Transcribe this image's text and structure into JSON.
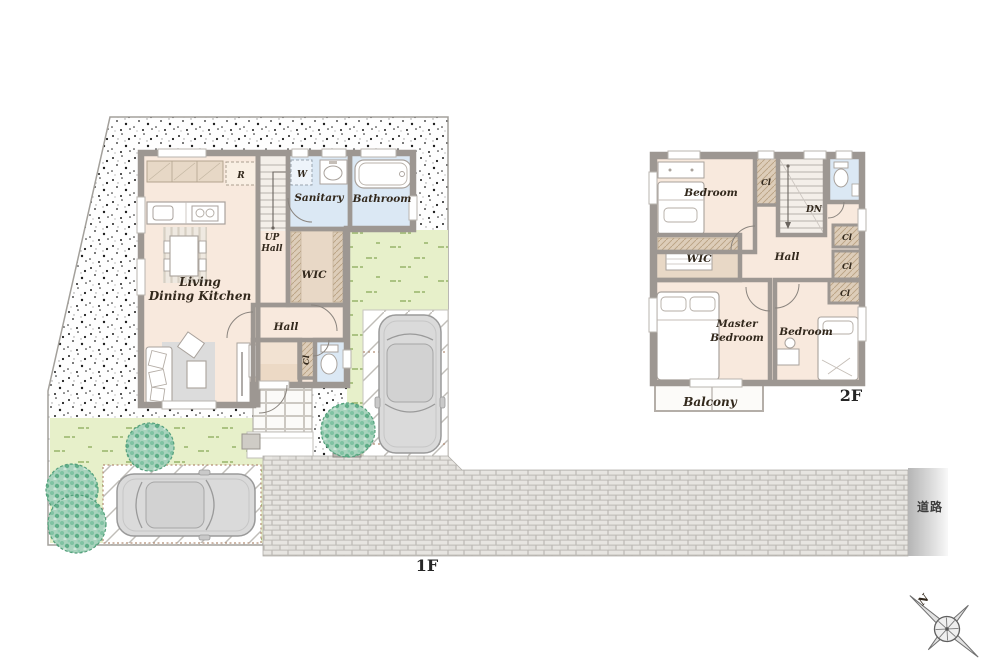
{
  "palette": {
    "floor": "#f8e9dd",
    "wet_room": "#dbe8f4",
    "closet": "#ddcdb9",
    "wall": "#9d9792",
    "grass": "#e7f0ca",
    "brick_road": "#e6e4e0",
    "road_strip": "#c2c2c2",
    "foliage": "#a8d3bd",
    "car_body": "#dadada"
  },
  "floor1": {
    "floor_label": "1F",
    "rooms": {
      "ldk_line1": "Living",
      "ldk_line2": "Dining Kitchen",
      "sanitary": "Sanitary",
      "bathroom": "Bathroom",
      "up": "UP",
      "up_hall": "Hall",
      "wic": "WIC",
      "hall": "Hall",
      "closet": "Cl",
      "refrigerator": "R",
      "washer": "W"
    }
  },
  "floor2": {
    "floor_label": "2F",
    "rooms": {
      "bedroom_top": "Bedroom",
      "closet_top": "Cl",
      "down": "DN",
      "hall": "Hall",
      "closet_a": "Cl",
      "closet_b": "Cl",
      "closet_c": "Cl",
      "wic": "WIC",
      "master_line1": "Master",
      "master_line2": "Bedroom",
      "bedroom_right": "Bedroom",
      "balcony": "Balcony"
    }
  },
  "site": {
    "road_label": "道路"
  },
  "compass": {
    "north_label": "N"
  }
}
